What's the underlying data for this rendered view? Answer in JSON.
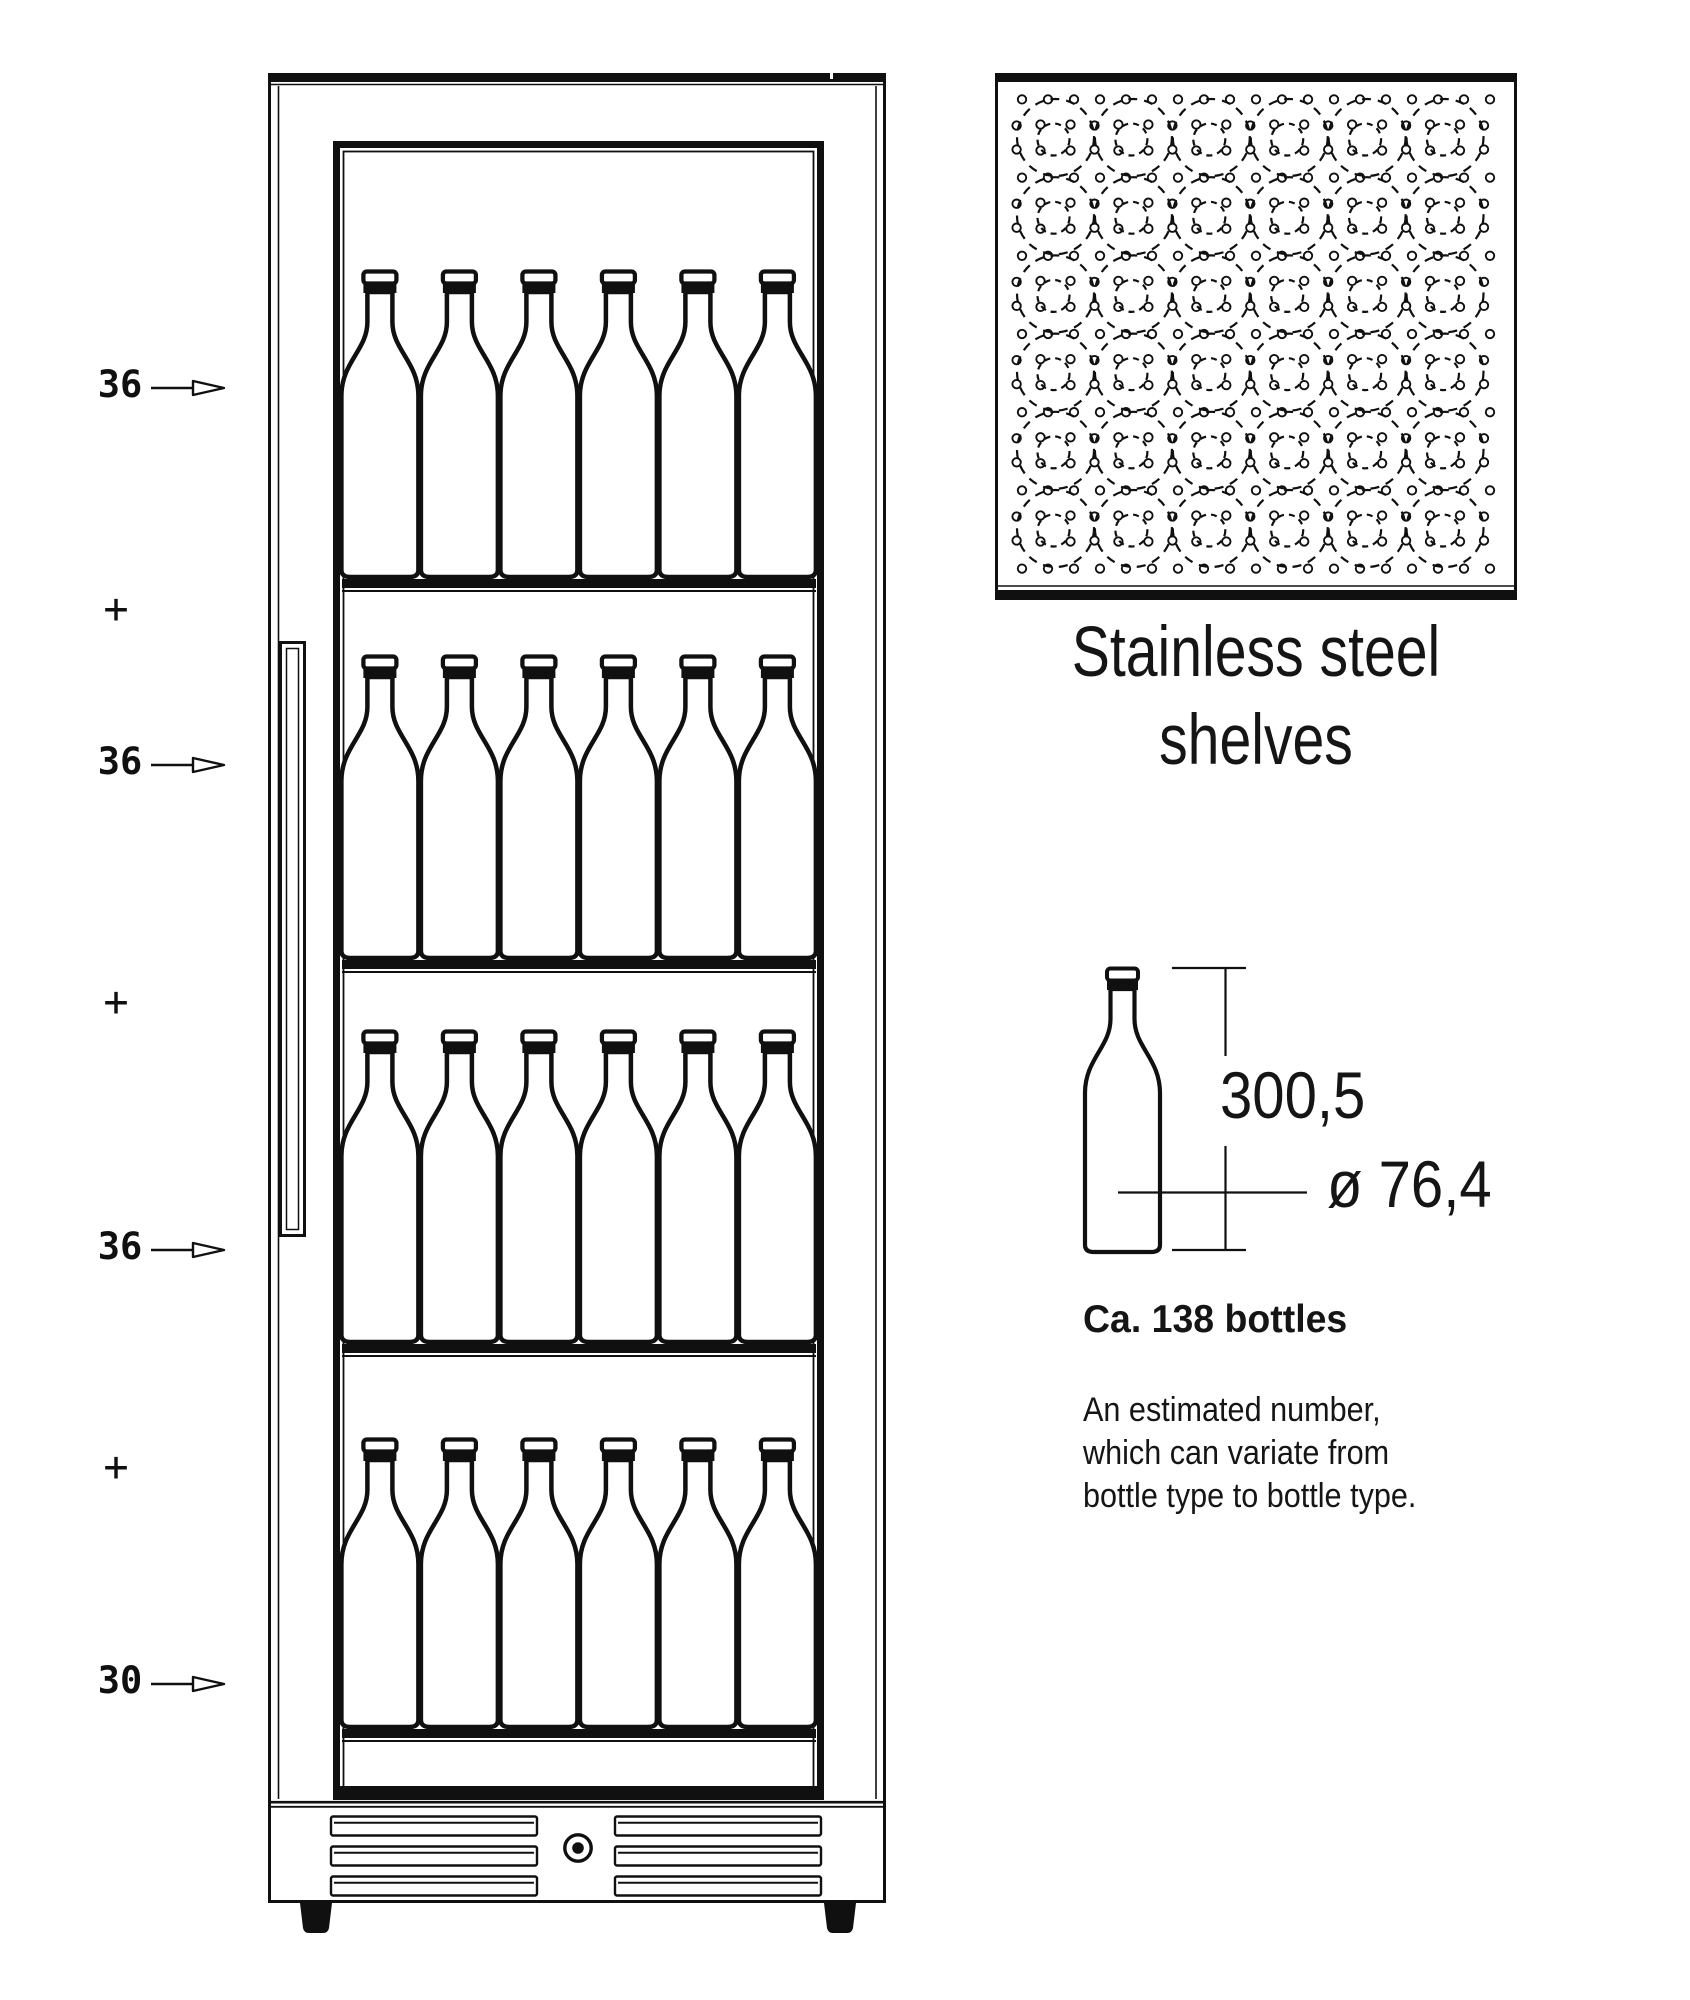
{
  "colors": {
    "ink": "#101010",
    "background": "#ffffff"
  },
  "capacity_labels": [
    {
      "text": "36",
      "icon": "right-arrow",
      "arrow": true
    },
    {
      "text": "+",
      "arrow": false
    },
    {
      "text": "36",
      "icon": "right-arrow",
      "arrow": true
    },
    {
      "text": "+",
      "arrow": false
    },
    {
      "text": "36",
      "icon": "right-arrow",
      "arrow": true
    },
    {
      "text": "+",
      "arrow": false
    },
    {
      "text": "30",
      "icon": "right-arrow",
      "arrow": true
    }
  ],
  "cabinet": {
    "shelves": 4,
    "bottles_per_visible_row": 6
  },
  "shelf_top_view": {
    "caption_line1": "Stainless steel",
    "caption_line2": "shelves",
    "bottle_positions_rows": 6,
    "bottle_positions_cols": 6
  },
  "bottle_dimensions": {
    "height_label": "300,5",
    "diameter_label": "ø 76,4"
  },
  "capacity_summary": {
    "title": "Ca. 138 bottles",
    "note_lines": [
      "An estimated number,",
      "which can variate from",
      "bottle type to bottle type."
    ]
  }
}
